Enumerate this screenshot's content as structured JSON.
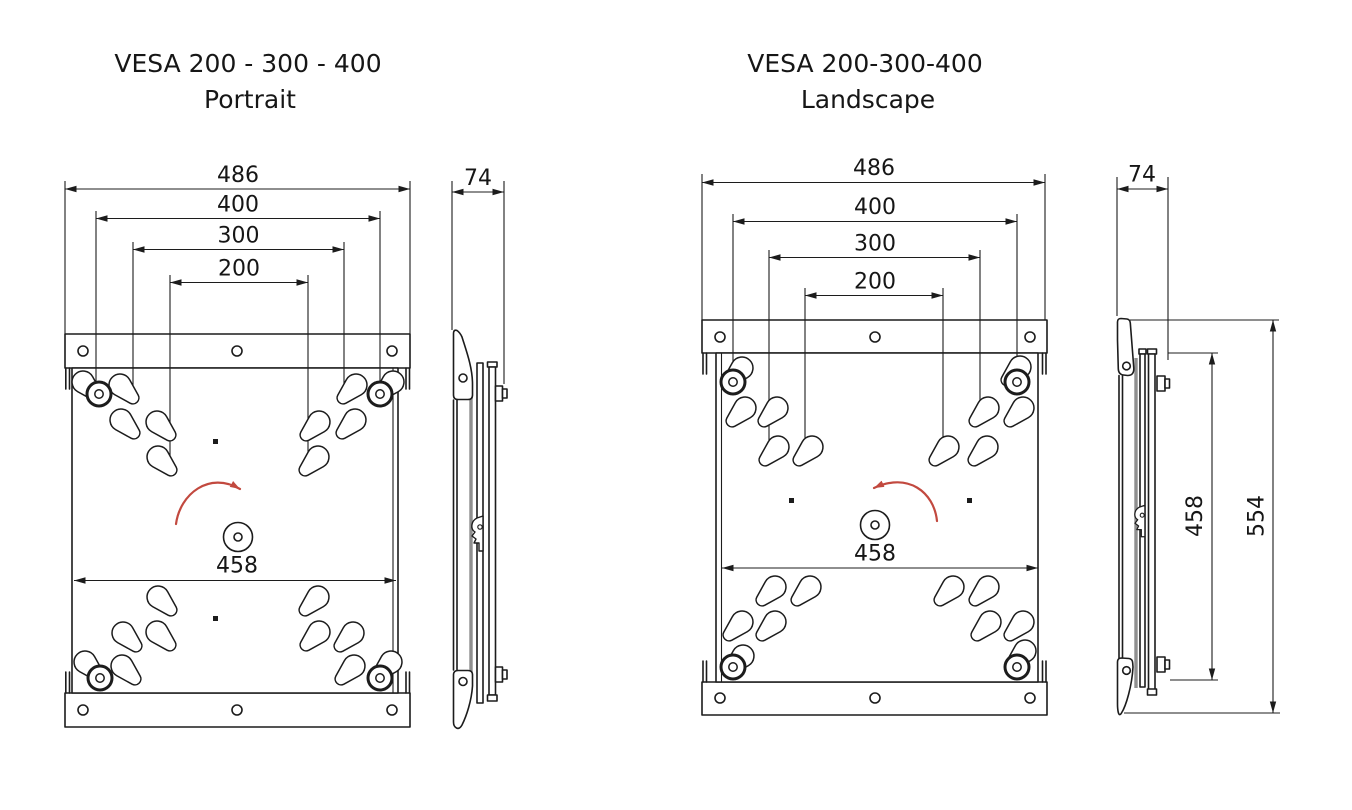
{
  "figures": {
    "portrait": {
      "title_line1": "VESA 200 - 300 - 400",
      "title_line2": "Portrait",
      "dims": {
        "overall_width": "486",
        "vesa_400": "400",
        "vesa_300": "300",
        "vesa_200": "200",
        "depth": "74",
        "turntable_width": "458"
      }
    },
    "landscape": {
      "title_line1": "VESA 200-300-400",
      "title_line2": "Landscape",
      "dims": {
        "overall_width": "486",
        "vesa_400": "400",
        "vesa_300": "300",
        "vesa_200": "200",
        "depth": "74",
        "turntable_width": "458",
        "plate_height": "458",
        "overall_height": "554"
      }
    }
  },
  "colors": {
    "line": "#1c1c1c",
    "rotation_arrow": "#c2493f",
    "gray_plate": "#8f8f8f",
    "background": "#ffffff"
  }
}
